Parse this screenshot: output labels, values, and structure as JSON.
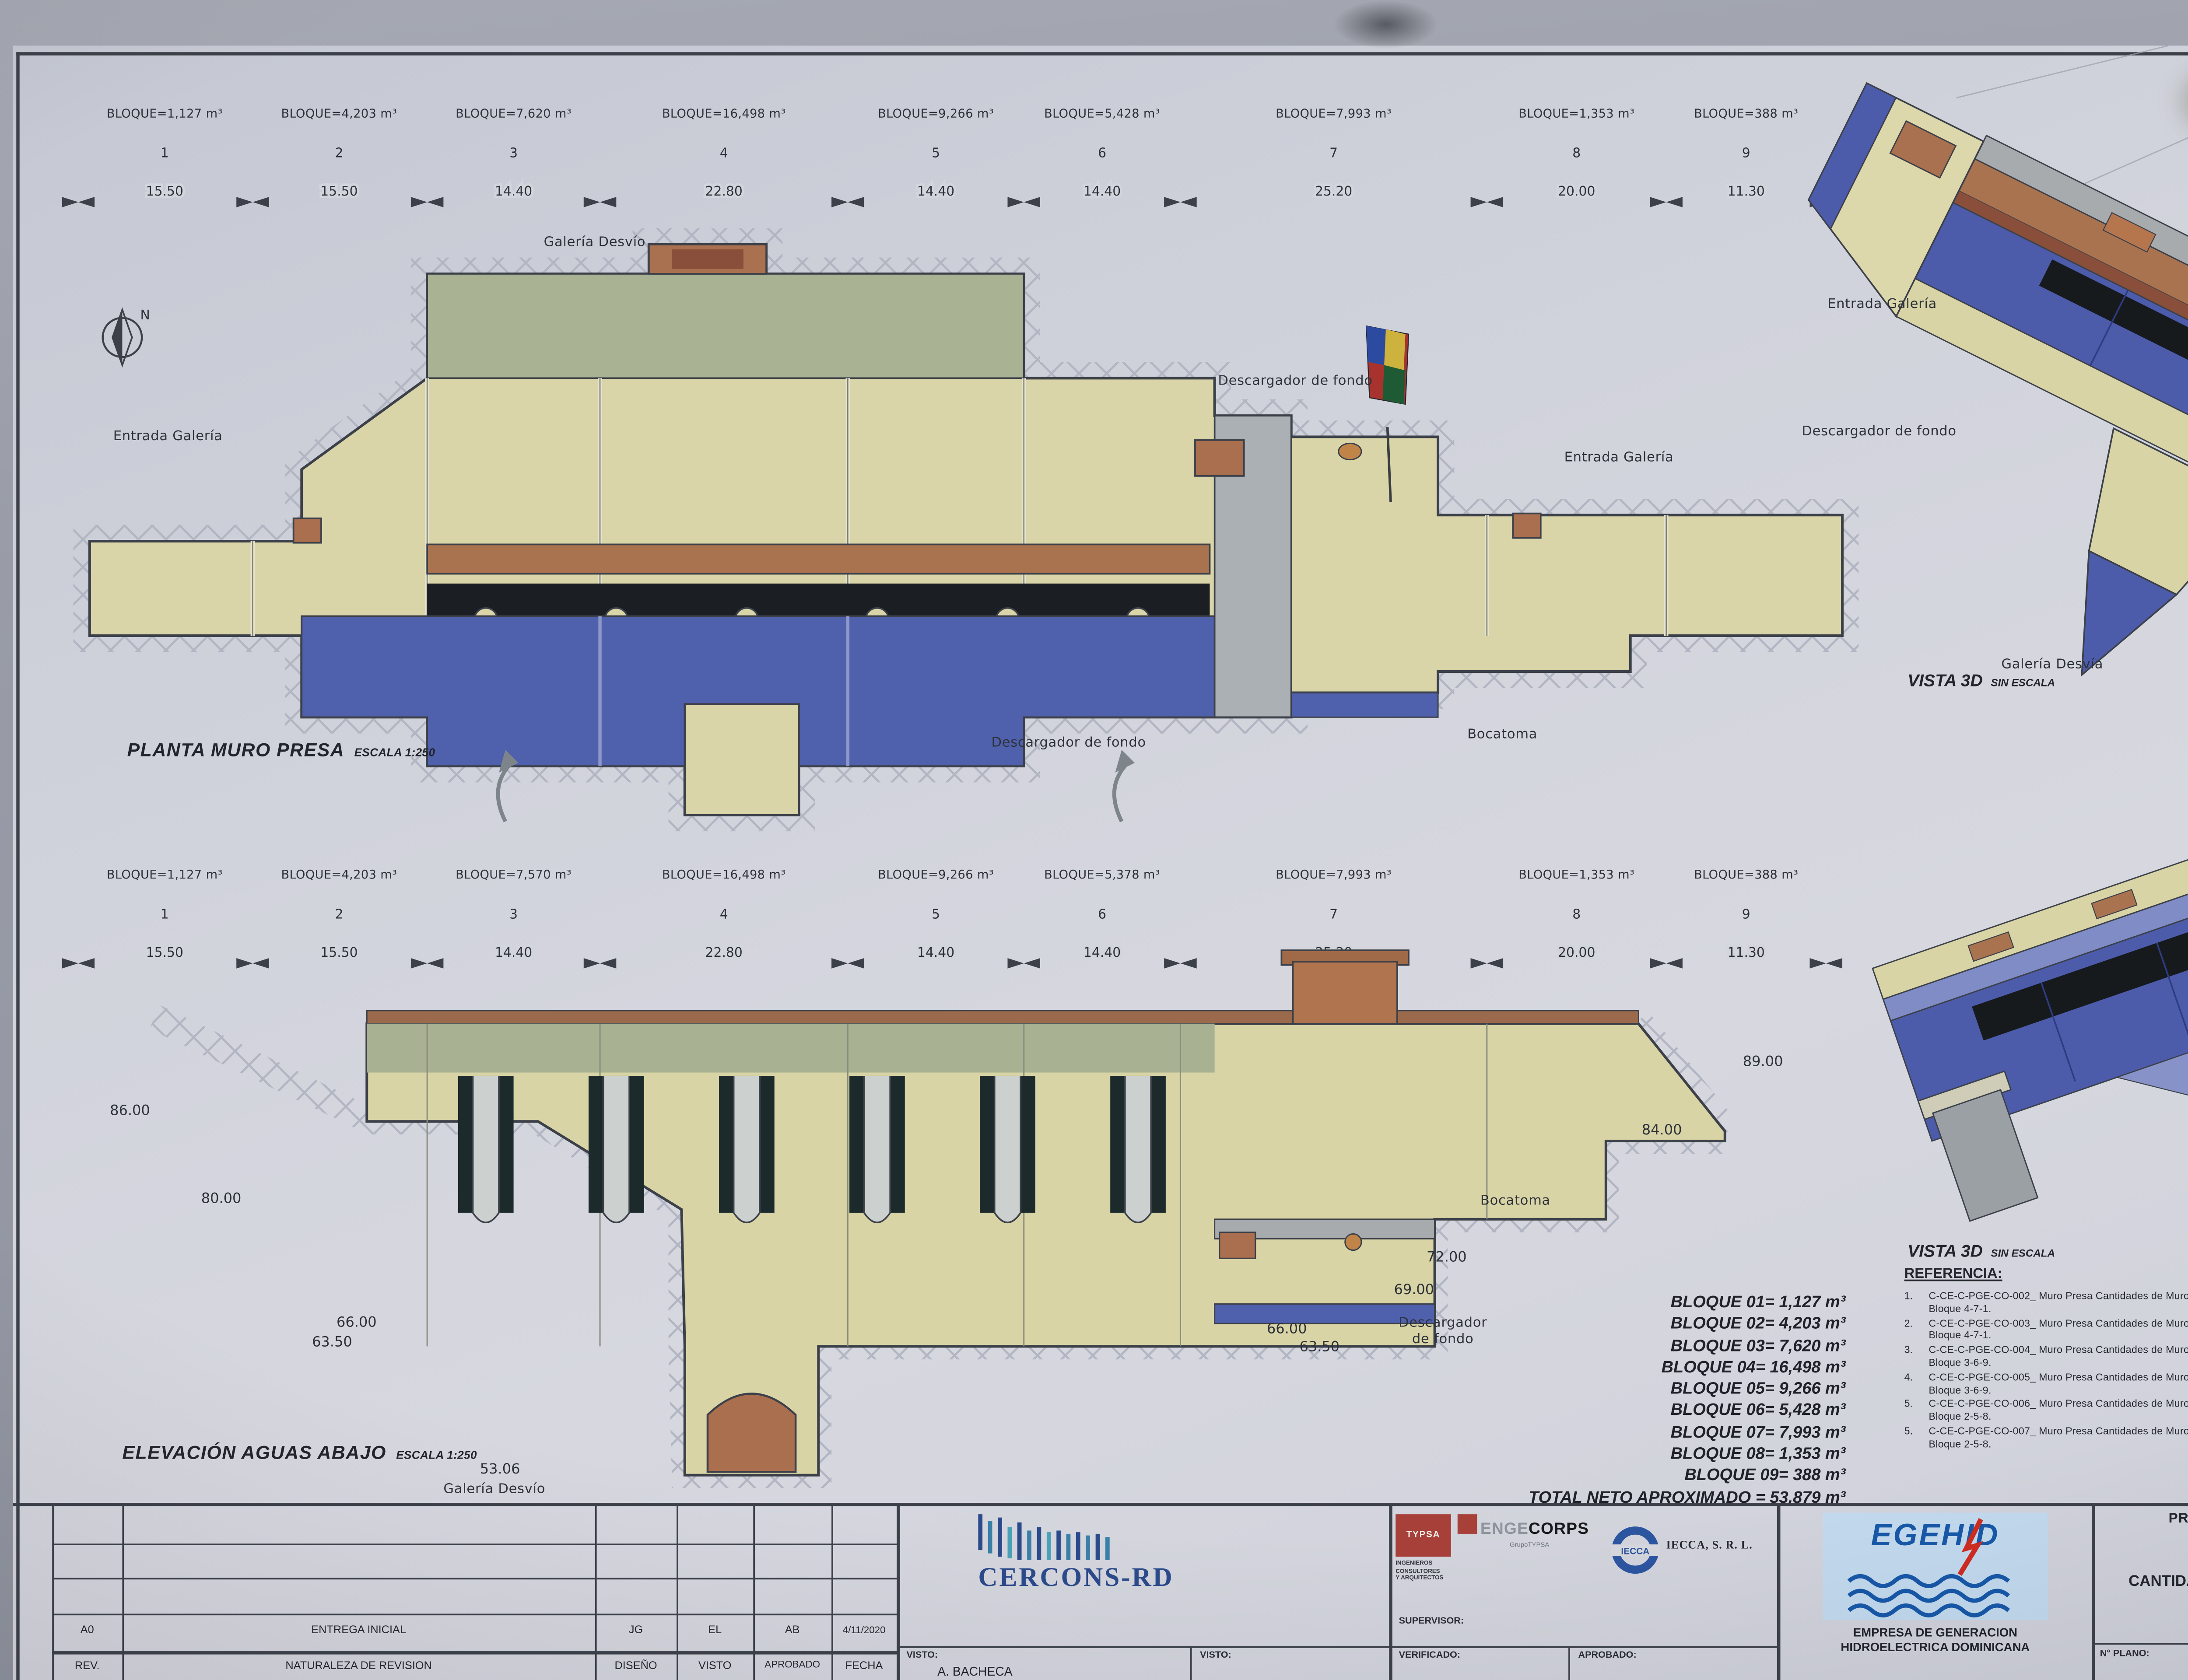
{
  "axes": {
    "top": {
      "blocks": [
        {
          "num": "1",
          "vol": "BLOQUE=1,127 m³"
        },
        {
          "num": "2",
          "vol": "BLOQUE=4,203 m³"
        },
        {
          "num": "3",
          "vol": "BLOQUE=7,620 m³"
        },
        {
          "num": "4",
          "vol": "BLOQUE=16,498 m³"
        },
        {
          "num": "5",
          "vol": "BLOQUE=9,266 m³"
        },
        {
          "num": "6",
          "vol": "BLOQUE=5,428 m³"
        },
        {
          "num": "7",
          "vol": "BLOQUE=7,993 m³"
        },
        {
          "num": "8",
          "vol": "BLOQUE=1,353 m³"
        },
        {
          "num": "9",
          "vol": "BLOQUE=388 m³"
        }
      ],
      "dims": [
        "15.50",
        "15.50",
        "14.40",
        "22.80",
        "14.40",
        "14.40",
        "25.20",
        "20.00",
        "11.30"
      ]
    },
    "bottom": {
      "blocks": [
        {
          "num": "1",
          "vol": "BLOQUE=1,127 m³"
        },
        {
          "num": "2",
          "vol": "BLOQUE=4,203 m³"
        },
        {
          "num": "3",
          "vol": "BLOQUE=7,570 m³"
        },
        {
          "num": "4",
          "vol": "BLOQUE=16,498 m³"
        },
        {
          "num": "5",
          "vol": "BLOQUE=9,266 m³"
        },
        {
          "num": "6",
          "vol": "BLOQUE=5,378 m³"
        },
        {
          "num": "7",
          "vol": "BLOQUE=7,993 m³"
        },
        {
          "num": "8",
          "vol": "BLOQUE=1,353 m³"
        },
        {
          "num": "9",
          "vol": "BLOQUE=388 m³"
        }
      ],
      "dims": [
        "15.50",
        "15.50",
        "14.40",
        "22.80",
        "14.40",
        "14.40",
        "25.20",
        "20.00",
        "11.30"
      ]
    }
  },
  "plan": {
    "title": "PLANTA MURO PRESA",
    "scale": "ESCALA 1:250",
    "labels": {
      "galeria_desvio": "Galería Desvío",
      "entrada_galeria_1": "Entrada Galería",
      "descargador_fondo_1": "Descargador de fondo",
      "entrada_galeria_2": "Entrada Galería",
      "descargador_fondo_2": "Descargador de fondo",
      "bocatoma": "Bocatoma",
      "north": "N"
    }
  },
  "elevation": {
    "title": "ELEVACIÓN AGUAS ABAJO",
    "scale": "ESCALA 1:250",
    "levels_left": [
      "86.00",
      "80.00",
      "66.00",
      "63.50",
      "53.06"
    ],
    "levels_right": [
      "89.00",
      "84.00",
      "72.00",
      "69.00",
      "66.00",
      "63.50"
    ],
    "labels": {
      "bocatoma": "Bocatoma",
      "descargador_l1": "Descargador",
      "descargador_l2": "de fondo",
      "galeria_desvio": "Galería Desvío"
    }
  },
  "vista1": {
    "caption": "VISTA 3D",
    "sub": "SIN ESCALA",
    "labels": {
      "entrada_galeria_1": "Entrada Galería",
      "descargador": "Descargador de fondo",
      "galeria": "Galería Desvía",
      "entrada_galeria_2": "Entrada Galería"
    }
  },
  "vista2": {
    "caption": "VISTA 3D",
    "sub": "SIN ESCALA",
    "labels": {
      "bocatoma": "Bocatoma",
      "descargador_l1": "Descargador",
      "descargador_l2": "de fondo",
      "galeria": "Galería Desvío"
    }
  },
  "bloque_totals": {
    "rows": [
      "BLOQUE 01= 1,127 m³",
      "BLOQUE 02= 4,203 m³",
      "BLOQUE 03= 7,620 m³",
      "BLOQUE 04= 16,498 m³",
      "BLOQUE 05= 9,266 m³",
      "BLOQUE 06= 5,428 m³",
      "BLOQUE 07= 7,993 m³",
      "BLOQUE 08= 1,353 m³",
      "BLOQUE 09= 388 m³"
    ],
    "total": "TOTAL NETO APROXIMADO = 53,879 m³"
  },
  "referencia": {
    "heading": "REFERENCIA:",
    "items": [
      {
        "num": "1.",
        "code": "C-CE-C-PGE-CO-002_",
        "desc": "Muro Presa Cantidades de Muro Bloque 4-7-1."
      },
      {
        "num": "2.",
        "code": "C-CE-C-PGE-CO-003_",
        "desc": "Muro Presa Cantidades de Muro Bloque 4-7-1."
      },
      {
        "num": "3.",
        "code": "C-CE-C-PGE-CO-004_",
        "desc": "Muro Presa Cantidades de Muro Bloque 3-6-9."
      },
      {
        "num": "4.",
        "code": "C-CE-C-PGE-CO-005_",
        "desc": "Muro Presa Cantidades de Muro Bloque 3-6-9."
      },
      {
        "num": "5.",
        "code": "C-CE-C-PGE-CO-006_",
        "desc": "Muro Presa Cantidades de Muro Bloque 2-5-8."
      },
      {
        "num": "5.",
        "code": "C-CE-C-PGE-CO-007_",
        "desc": "Muro Presa Cantidades de Muro Bloque 2-5-8."
      }
    ]
  },
  "notas": {
    "heading": "NOTAS",
    "num": "1.",
    "line1": "TODAS LAS MEDIDAS SON EN METROS SAL",
    "line2": "INDICACION CONTRARIA."
  },
  "titleblock": {
    "revision": {
      "rev_val": "A0",
      "desc_val": "ENTREGA INICIAL",
      "c1_val": "JG",
      "c2_val": "EL",
      "c3_val": "AB",
      "c4_val": "4/11/2020",
      "rev_h": "REV.",
      "desc_h": "NATURALEZA DE REVISION",
      "c1_h": "DISEÑO",
      "c2_h": "VISTO",
      "c3_h": "APROBADO",
      "c4_h": "FECHA"
    },
    "cercons": "CERCONS-RD",
    "visto1_label": "VISTO:",
    "visto1_value": "A. BACHECA",
    "visto2_label": "VISTO:",
    "supervisor_label": "SUPERVISOR:",
    "verificado_label": "VERIFICADO:",
    "aprobado_label": "APROBADO:",
    "typsa": {
      "name": "TYPSA",
      "sub1": "INGENIEROS",
      "sub2": "CONSULTORES",
      "sub3": "Y ARQUITECTOS"
    },
    "engecorps": {
      "name1": "ENGE",
      "name2": "CORPS",
      "sub": "GrupoTYPSA"
    },
    "iecca": {
      "circle_text": "IECCA",
      "name": "IECCA, S. R. L."
    },
    "egehid": {
      "logo": "EGEHID",
      "line1": "EMPRESA DE GENERACION",
      "line2": "HIDROELECTRICA DOMINICANA"
    },
    "project": "PROYECTO PRESA DE GUAYUBIN",
    "t1": "PRESA",
    "t2": "CANTIDADES DE HORMIGÓN DE BLOQUES",
    "t3": "VISTAS 3D",
    "plano_label": "N° PLANO:",
    "plano": "C-CE-C-PGE-CO-001",
    "escala_label": "ESCALA:",
    "escala_value": "INDI",
    "fecha_label": "FECHA:",
    "fecha_value": "4/11/",
    "hojas_label": "HOJAS:",
    "rev_label": "REV.:"
  },
  "colors": {
    "paper": "#d3d5dd",
    "ink": "#3c4049",
    "yellow": "#d9d5a8",
    "olive": "#a9b394",
    "blue": "#4f60ad",
    "brown": "#aa7350",
    "accent_red": "#a8403a",
    "egehid_blue": "#1758a8"
  }
}
